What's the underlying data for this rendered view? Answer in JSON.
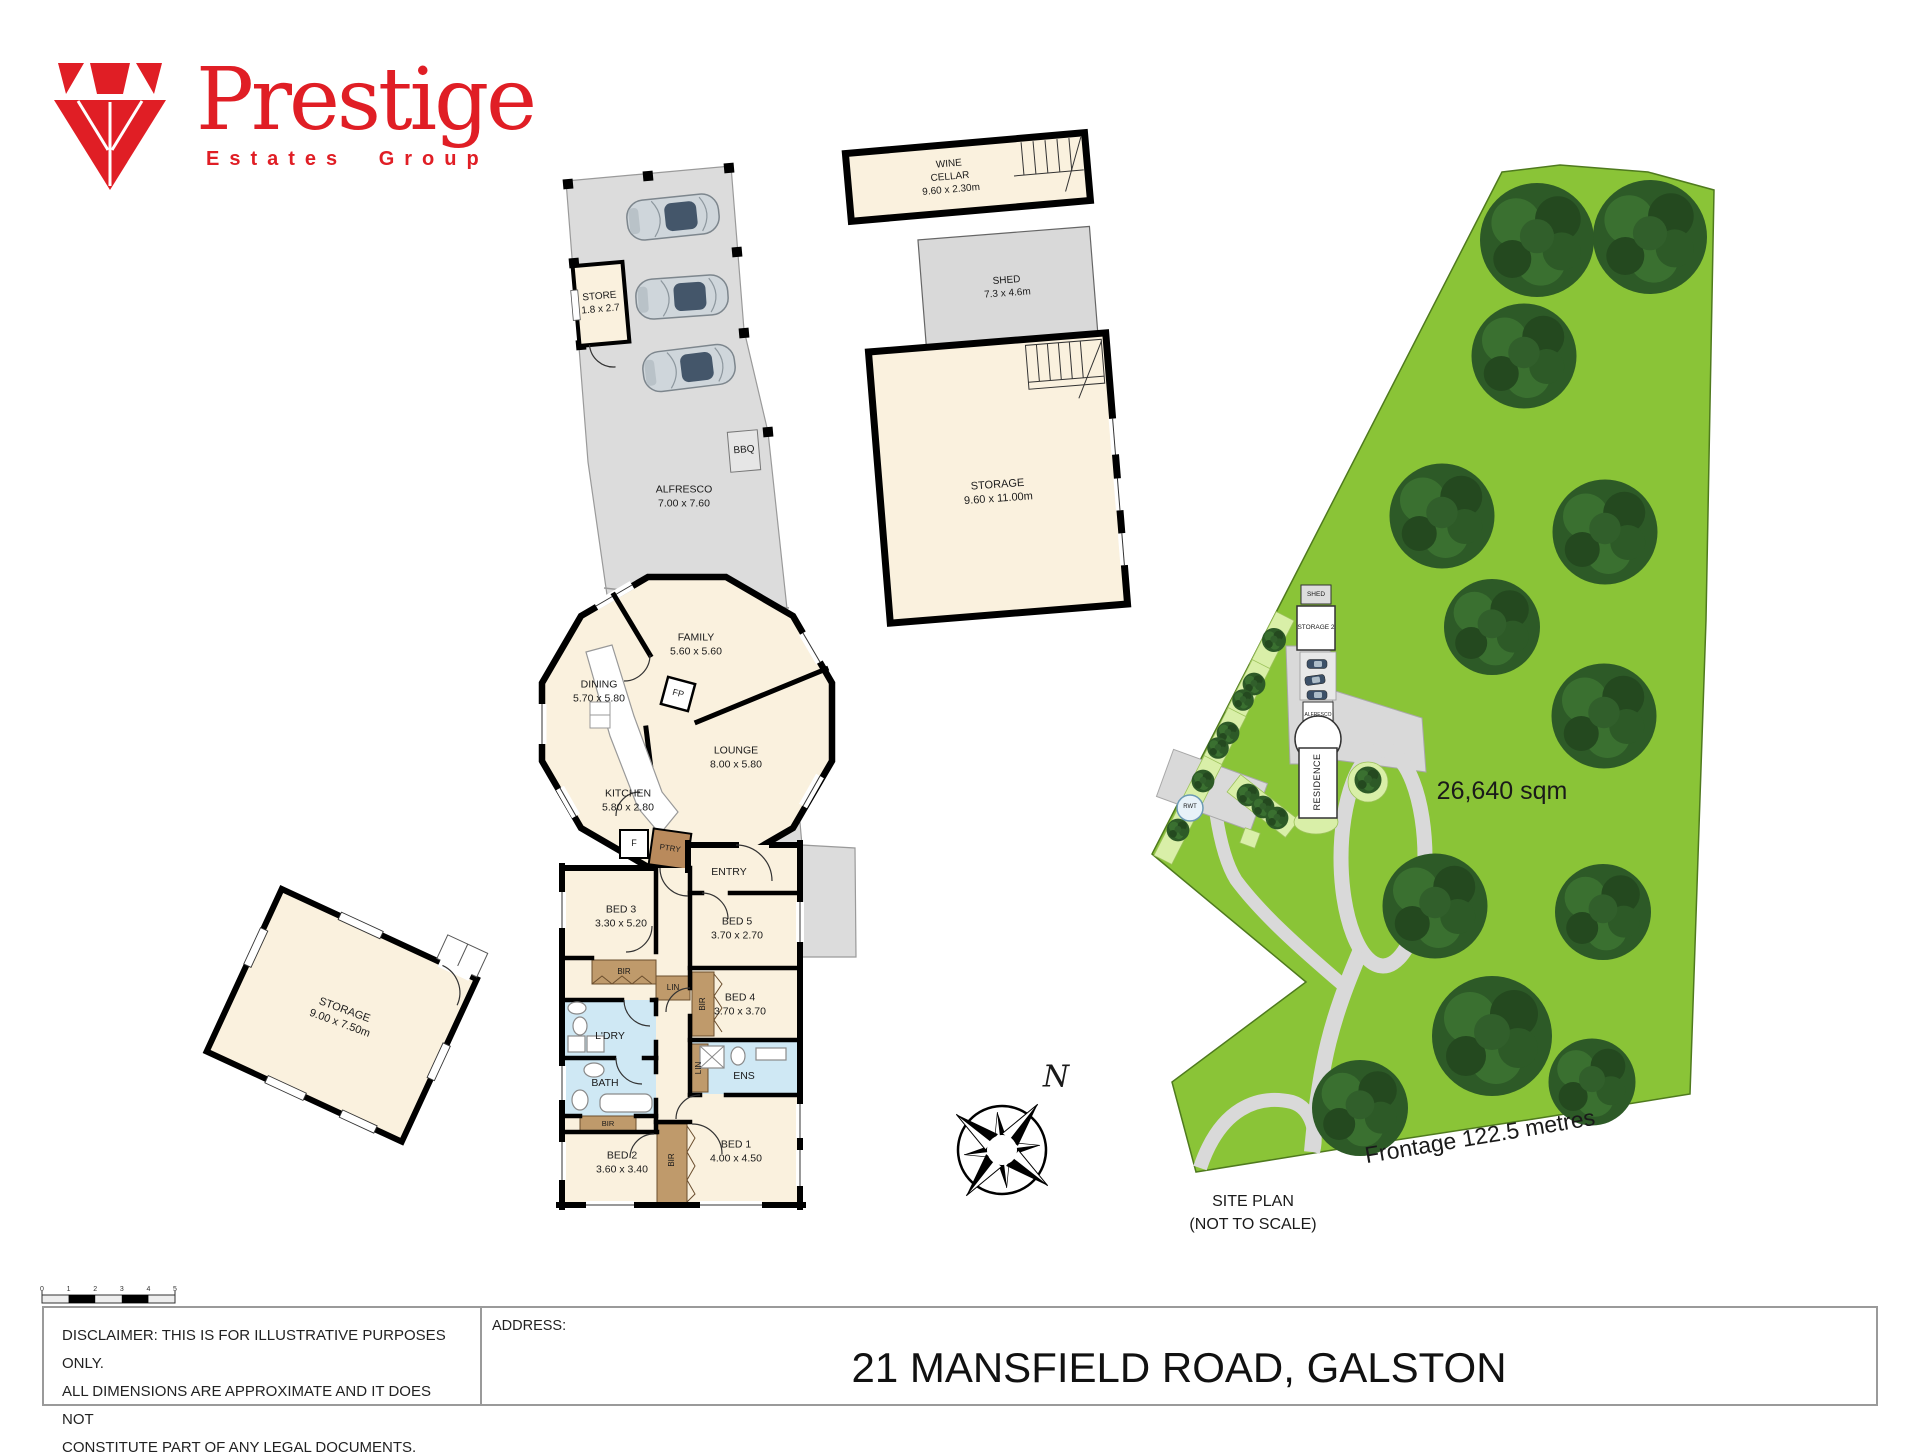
{
  "logo": {
    "brand": "Prestige",
    "subtitle": "Estates Group"
  },
  "floorplan": {
    "store": {
      "name": "STORE",
      "dims": "1.8 x 2.7"
    },
    "bbq": {
      "name": "BBQ"
    },
    "alfresco": {
      "name": "ALFRESCO",
      "dims": "7.00 x 7.60"
    },
    "wine_cellar": {
      "line1": "WINE",
      "line2": "CELLAR",
      "dims": "9.60 x 2.30m"
    },
    "shed": {
      "name": "SHED",
      "dims": "7.3 x 4.6m"
    },
    "storage_upper": {
      "name": "STORAGE",
      "dims": "9.60 x 11.00m"
    },
    "storage_detached": {
      "name": "STORAGE",
      "dims": "9.00 x 7.50m"
    },
    "family": {
      "name": "FAMILY",
      "dims": "5.60 x 5.60"
    },
    "dining": {
      "name": "DINING",
      "dims": "5.70 x 5.80"
    },
    "lounge": {
      "name": "LOUNGE",
      "dims": "8.00 x 5.80"
    },
    "kitchen": {
      "name": "KITCHEN",
      "dims": "5.80 x 2.80"
    },
    "fp": {
      "name": "FP"
    },
    "fridge": {
      "name": "F"
    },
    "pantry": {
      "name": "PTRY"
    },
    "entry": {
      "name": "ENTRY"
    },
    "bed1": {
      "name": "BED 1",
      "dims": "4.00 x 4.50"
    },
    "bed2": {
      "name": "BED 2",
      "dims": "3.60 x 3.40"
    },
    "bed3": {
      "name": "BED 3",
      "dims": "3.30 x 5.20"
    },
    "bed4": {
      "name": "BED 4",
      "dims": "3.70 x 3.70"
    },
    "bed5": {
      "name": "BED 5",
      "dims": "3.70 x 2.70"
    },
    "bath": {
      "name": "BATH"
    },
    "ens": {
      "name": "ENS"
    },
    "laundry": {
      "name": "L'DRY"
    },
    "bir": {
      "name": "BIR"
    },
    "lin": {
      "name": "LIN"
    }
  },
  "siteplan": {
    "area": "26,640 sqm",
    "frontage": "Frontage 122.5 metres",
    "caption_line1": "SITE PLAN",
    "caption_line2": "(NOT TO SCALE)",
    "shed": "SHED",
    "storage2": "STORAGE 2",
    "alfresco": "ALFRESCO",
    "residence": "RESIDENCE",
    "rwt": "RWT"
  },
  "compass": {
    "north_label": "N"
  },
  "scalebar": {
    "ticks": [
      "0",
      "1",
      "2",
      "3",
      "4",
      "5"
    ]
  },
  "footer": {
    "disclaimer_line1": "DISCLAIMER: THIS IS FOR ILLUSTRATIVE PURPOSES ONLY.",
    "disclaimer_line2": "ALL DIMENSIONS ARE APPROXIMATE AND IT DOES NOT",
    "disclaimer_line3": "CONSTITUTE PART OF ANY LEGAL DOCUMENTS.",
    "address_label": "ADDRESS:",
    "address": "21 MANSFIELD ROAD, GALSTON"
  },
  "colors": {
    "brand_red": "#e01e25",
    "land_green": "#8ac437",
    "room_cream": "#faf1de",
    "wet_blue": "#cfe8f4",
    "robe_brown": "#bf9a6b",
    "area_grey": "#dcdcdc",
    "wall_black": "#000000"
  }
}
